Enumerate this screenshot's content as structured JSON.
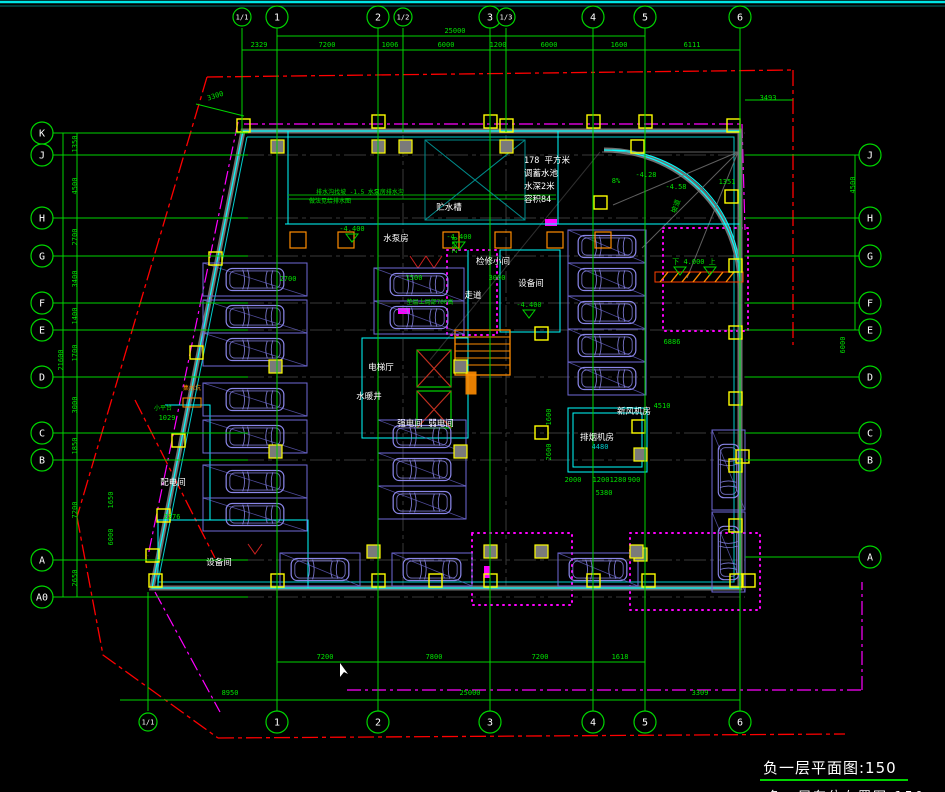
{
  "canvas": {
    "w": 945,
    "h": 792,
    "bg": "#000000"
  },
  "title": {
    "text": "负一层平面图:150",
    "partial_caption": "负一层车位布置图:150"
  },
  "colors": {
    "grid_green": "#00d400",
    "text_green": "#00e000",
    "cyan_wall": "#00ffff",
    "teal": "#008b8b",
    "red_line": "#ff0000",
    "magenta": "#ff00ff",
    "violet_car": "#8a86e8",
    "violet_stall": "#6f6ad8",
    "yellow_col": "#ffff00",
    "orange": "#ff8c00",
    "gray_line": "#5a5a5a",
    "white": "#ffffff"
  },
  "grid": {
    "top": [
      {
        "label": "1/1",
        "x": 242,
        "aux": true
      },
      {
        "label": "1",
        "x": 277
      },
      {
        "label": "2",
        "x": 378
      },
      {
        "label": "1/2",
        "x": 403,
        "aux": true
      },
      {
        "label": "3",
        "x": 490
      },
      {
        "label": "1/3",
        "x": 506,
        "aux": true
      },
      {
        "label": "4",
        "x": 593
      },
      {
        "label": "5",
        "x": 645
      },
      {
        "label": "6",
        "x": 740
      }
    ],
    "bottom": [
      {
        "label": "1/1",
        "x": 148,
        "aux": true
      },
      {
        "label": "1",
        "x": 277
      },
      {
        "label": "2",
        "x": 378
      },
      {
        "label": "3",
        "x": 490
      },
      {
        "label": "4",
        "x": 593
      },
      {
        "label": "5",
        "x": 645
      },
      {
        "label": "6",
        "x": 740
      }
    ],
    "left": [
      {
        "label": "K",
        "y": 133
      },
      {
        "label": "J",
        "y": 155
      },
      {
        "label": "H",
        "y": 218
      },
      {
        "label": "G",
        "y": 256
      },
      {
        "label": "F",
        "y": 303
      },
      {
        "label": "E",
        "y": 330
      },
      {
        "label": "D",
        "y": 377
      },
      {
        "label": "C",
        "y": 433
      },
      {
        "label": "B",
        "y": 460
      },
      {
        "label": "A",
        "y": 560
      },
      {
        "label": "A0",
        "y": 597
      }
    ],
    "right": [
      {
        "label": "J",
        "y": 155
      },
      {
        "label": "H",
        "y": 218
      },
      {
        "label": "G",
        "y": 256
      },
      {
        "label": "F",
        "y": 303
      },
      {
        "label": "E",
        "y": 330
      },
      {
        "label": "D",
        "y": 377
      },
      {
        "label": "C",
        "y": 433
      },
      {
        "label": "B",
        "y": 460
      },
      {
        "label": "A",
        "y": 557
      }
    ]
  },
  "dims": {
    "top": [
      {
        "t": "2329",
        "x": 259,
        "y": 47
      },
      {
        "t": "7200",
        "x": 327,
        "y": 47
      },
      {
        "t": "1006",
        "x": 390,
        "y": 47
      },
      {
        "t": "6000",
        "x": 446,
        "y": 47
      },
      {
        "t": "1200",
        "x": 498,
        "y": 47
      },
      {
        "t": "6000",
        "x": 549,
        "y": 47
      },
      {
        "t": "1600",
        "x": 619,
        "y": 47
      },
      {
        "t": "6111",
        "x": 692,
        "y": 47
      },
      {
        "t": "25000",
        "x": 455,
        "y": 33
      },
      {
        "t": "3300",
        "x": 216,
        "y": 98,
        "rot": -18
      },
      {
        "t": "3493",
        "x": 768,
        "y": 100
      }
    ],
    "left": [
      {
        "t": "1350",
        "x": 77,
        "y": 144,
        "rot": -90
      },
      {
        "t": "4500",
        "x": 77,
        "y": 186,
        "rot": -90
      },
      {
        "t": "2700",
        "x": 77,
        "y": 237,
        "rot": -90
      },
      {
        "t": "3400",
        "x": 77,
        "y": 279,
        "rot": -90
      },
      {
        "t": "1400",
        "x": 77,
        "y": 316,
        "rot": -90
      },
      {
        "t": "1700",
        "x": 77,
        "y": 353,
        "rot": -90
      },
      {
        "t": "3000",
        "x": 77,
        "y": 405,
        "rot": -90
      },
      {
        "t": "1850",
        "x": 77,
        "y": 446,
        "rot": -90
      },
      {
        "t": "7200",
        "x": 77,
        "y": 510,
        "rot": -90
      },
      {
        "t": "2650",
        "x": 77,
        "y": 578,
        "rot": -90
      },
      {
        "t": "21600",
        "x": 63,
        "y": 360,
        "rot": -90
      },
      {
        "t": "1650",
        "x": 113,
        "y": 500,
        "rot": -90
      },
      {
        "t": "6000",
        "x": 113,
        "y": 537,
        "rot": -90
      }
    ],
    "right": [
      {
        "t": "4500",
        "x": 855,
        "y": 185,
        "rot": -90
      },
      {
        "t": "6000",
        "x": 845,
        "y": 345,
        "rot": -90
      },
      {
        "t": "1351",
        "x": 727,
        "y": 184
      }
    ],
    "bottom": [
      {
        "t": "7200",
        "x": 325,
        "y": 659
      },
      {
        "t": "7800",
        "x": 434,
        "y": 659
      },
      {
        "t": "7200",
        "x": 540,
        "y": 659
      },
      {
        "t": "1618",
        "x": 620,
        "y": 659
      },
      {
        "t": "8950",
        "x": 230,
        "y": 695
      },
      {
        "t": "25000",
        "x": 470,
        "y": 695
      },
      {
        "t": "3309",
        "x": 700,
        "y": 695
      }
    ],
    "center": [
      {
        "t": "2950",
        "x": 457,
        "y": 245,
        "rot": -90
      },
      {
        "t": "2700",
        "x": 288,
        "y": 281
      },
      {
        "t": "1500",
        "x": 414,
        "y": 280
      },
      {
        "t": "3000",
        "x": 497,
        "y": 280
      },
      {
        "t": "6886",
        "x": 672,
        "y": 344
      },
      {
        "t": "4510",
        "x": 662,
        "y": 408
      },
      {
        "t": "5380",
        "x": 604,
        "y": 495
      },
      {
        "t": "2000",
        "x": 573,
        "y": 482
      },
      {
        "t": "1200",
        "x": 601,
        "y": 482
      },
      {
        "t": "1280",
        "x": 618,
        "y": 482
      },
      {
        "t": "900",
        "x": 634,
        "y": 482
      },
      {
        "t": "1600",
        "x": 551,
        "y": 417,
        "rot": -90
      },
      {
        "t": "2600",
        "x": 551,
        "y": 452,
        "rot": -90
      },
      {
        "t": "4480",
        "x": 600,
        "y": 449,
        "c": "#00cccc"
      },
      {
        "t": "1029",
        "x": 167,
        "y": 420
      },
      {
        "t": "2276",
        "x": 172,
        "y": 519
      }
    ]
  },
  "rooms": [
    {
      "t": "水泵房",
      "x": 396,
      "y": 241
    },
    {
      "t": "贮水槽",
      "x": 449,
      "y": 210
    },
    {
      "t": "电梯厅",
      "x": 381,
      "y": 370
    },
    {
      "t": "设备间",
      "x": 531,
      "y": 286
    },
    {
      "t": "检修小间",
      "x": 493,
      "y": 264
    },
    {
      "t": "强电间",
      "x": 410,
      "y": 426
    },
    {
      "t": "弱电间",
      "x": 441,
      "y": 426
    },
    {
      "t": "配电间",
      "x": 173,
      "y": 485
    },
    {
      "t": "设备间",
      "x": 219,
      "y": 565
    },
    {
      "t": "排烟机房",
      "x": 597,
      "y": 440
    },
    {
      "t": "新风机房",
      "x": 634,
      "y": 414
    },
    {
      "t": "水暖井",
      "x": 369,
      "y": 399
    },
    {
      "t": "走道",
      "x": 473,
      "y": 298
    }
  ],
  "pool": {
    "x": 524,
    "y": 163,
    "lh": 13,
    "lines": [
      "178 平方米",
      "调蓄水池",
      "水深2米",
      "容积84"
    ]
  },
  "notes": [
    {
      "t": "-4.400",
      "x": 352,
      "y": 231
    },
    {
      "t": "-4.400",
      "x": 459,
      "y": 239
    },
    {
      "t": "-4.400",
      "x": 529,
      "y": 307
    },
    {
      "t": "下 4.000 上",
      "x": 694,
      "y": 264
    },
    {
      "t": "-4.28",
      "x": 646,
      "y": 177
    },
    {
      "t": "-4.58",
      "x": 676,
      "y": 189
    },
    {
      "t": "8%",
      "x": 616,
      "y": 183
    },
    {
      "t": "坡道",
      "x": 678,
      "y": 207,
      "rot": -70
    },
    {
      "t": "排水沟找坡 -1.5 水泵房排水沟",
      "x": 360,
      "y": 194,
      "s": 6
    },
    {
      "t": "做法见给排水图",
      "x": 330,
      "y": 203,
      "s": 6
    },
    {
      "t": "垫层上局部700高",
      "x": 430,
      "y": 304,
      "s": 6
    },
    {
      "t": "小平台",
      "x": 163,
      "y": 410,
      "s": 6
    },
    {
      "t": "集水坑",
      "x": 192,
      "y": 390,
      "s": 6,
      "c": "#ff8c00"
    }
  ],
  "parking": {
    "stalls": [
      {
        "x": 203,
        "y": 263,
        "w": 104,
        "h": 33,
        "o": "h"
      },
      {
        "x": 203,
        "y": 300,
        "w": 104,
        "h": 33,
        "o": "h"
      },
      {
        "x": 203,
        "y": 333,
        "w": 104,
        "h": 33,
        "o": "h"
      },
      {
        "x": 203,
        "y": 383,
        "w": 104,
        "h": 33,
        "o": "h"
      },
      {
        "x": 203,
        "y": 420,
        "w": 104,
        "h": 33,
        "o": "h"
      },
      {
        "x": 203,
        "y": 465,
        "w": 104,
        "h": 33,
        "o": "h"
      },
      {
        "x": 203,
        "y": 498,
        "w": 104,
        "h": 33,
        "o": "h"
      },
      {
        "x": 374,
        "y": 268,
        "w": 90,
        "h": 33,
        "o": "h"
      },
      {
        "x": 374,
        "y": 301,
        "w": 90,
        "h": 33,
        "o": "h"
      },
      {
        "x": 378,
        "y": 420,
        "w": 88,
        "h": 33,
        "o": "h"
      },
      {
        "x": 378,
        "y": 453,
        "w": 88,
        "h": 33,
        "o": "h"
      },
      {
        "x": 378,
        "y": 486,
        "w": 88,
        "h": 33,
        "o": "h"
      },
      {
        "x": 568,
        "y": 230,
        "w": 78,
        "h": 33,
        "o": "h"
      },
      {
        "x": 568,
        "y": 263,
        "w": 78,
        "h": 33,
        "o": "h"
      },
      {
        "x": 568,
        "y": 296,
        "w": 78,
        "h": 33,
        "o": "h"
      },
      {
        "x": 568,
        "y": 329,
        "w": 78,
        "h": 33,
        "o": "h"
      },
      {
        "x": 568,
        "y": 362,
        "w": 78,
        "h": 33,
        "o": "h"
      },
      {
        "x": 280,
        "y": 553,
        "w": 80,
        "h": 33,
        "o": "h"
      },
      {
        "x": 392,
        "y": 553,
        "w": 80,
        "h": 33,
        "o": "h"
      },
      {
        "x": 558,
        "y": 553,
        "w": 80,
        "h": 33,
        "o": "h"
      },
      {
        "x": 712,
        "y": 430,
        "w": 33,
        "h": 80,
        "o": "v"
      },
      {
        "x": 712,
        "y": 512,
        "w": 33,
        "h": 80,
        "o": "v"
      }
    ]
  },
  "columns": {
    "orange_x": [
      290,
      338,
      443,
      495,
      547,
      595
    ],
    "orange_y": 232,
    "yellow": [
      [
        243,
        125
      ],
      [
        378,
        121
      ],
      [
        490,
        121
      ],
      [
        506,
        125
      ],
      [
        593,
        121
      ],
      [
        645,
        121
      ],
      [
        733,
        125
      ],
      [
        637,
        146
      ],
      [
        600,
        202
      ],
      [
        731,
        196
      ],
      [
        735,
        265
      ],
      [
        735,
        332
      ],
      [
        735,
        398
      ],
      [
        735,
        465
      ],
      [
        735,
        525
      ],
      [
        215,
        258
      ],
      [
        196,
        352
      ],
      [
        178,
        440
      ],
      [
        163,
        515
      ],
      [
        152,
        555
      ],
      [
        155,
        580
      ],
      [
        277,
        580
      ],
      [
        378,
        580
      ],
      [
        435,
        580
      ],
      [
        490,
        580
      ],
      [
        593,
        580
      ],
      [
        648,
        580
      ],
      [
        736,
        580
      ],
      [
        541,
        333
      ],
      [
        541,
        432
      ],
      [
        638,
        426
      ],
      [
        742,
        456
      ],
      [
        748,
        580
      ]
    ],
    "gray": [
      [
        277,
        146
      ],
      [
        378,
        146
      ],
      [
        405,
        146
      ],
      [
        506,
        146
      ],
      [
        275,
        366
      ],
      [
        275,
        451
      ],
      [
        460,
        366
      ],
      [
        460,
        451
      ],
      [
        640,
        454
      ],
      [
        640,
        554
      ],
      [
        373,
        551
      ],
      [
        490,
        551
      ],
      [
        541,
        551
      ],
      [
        636,
        551
      ]
    ]
  }
}
